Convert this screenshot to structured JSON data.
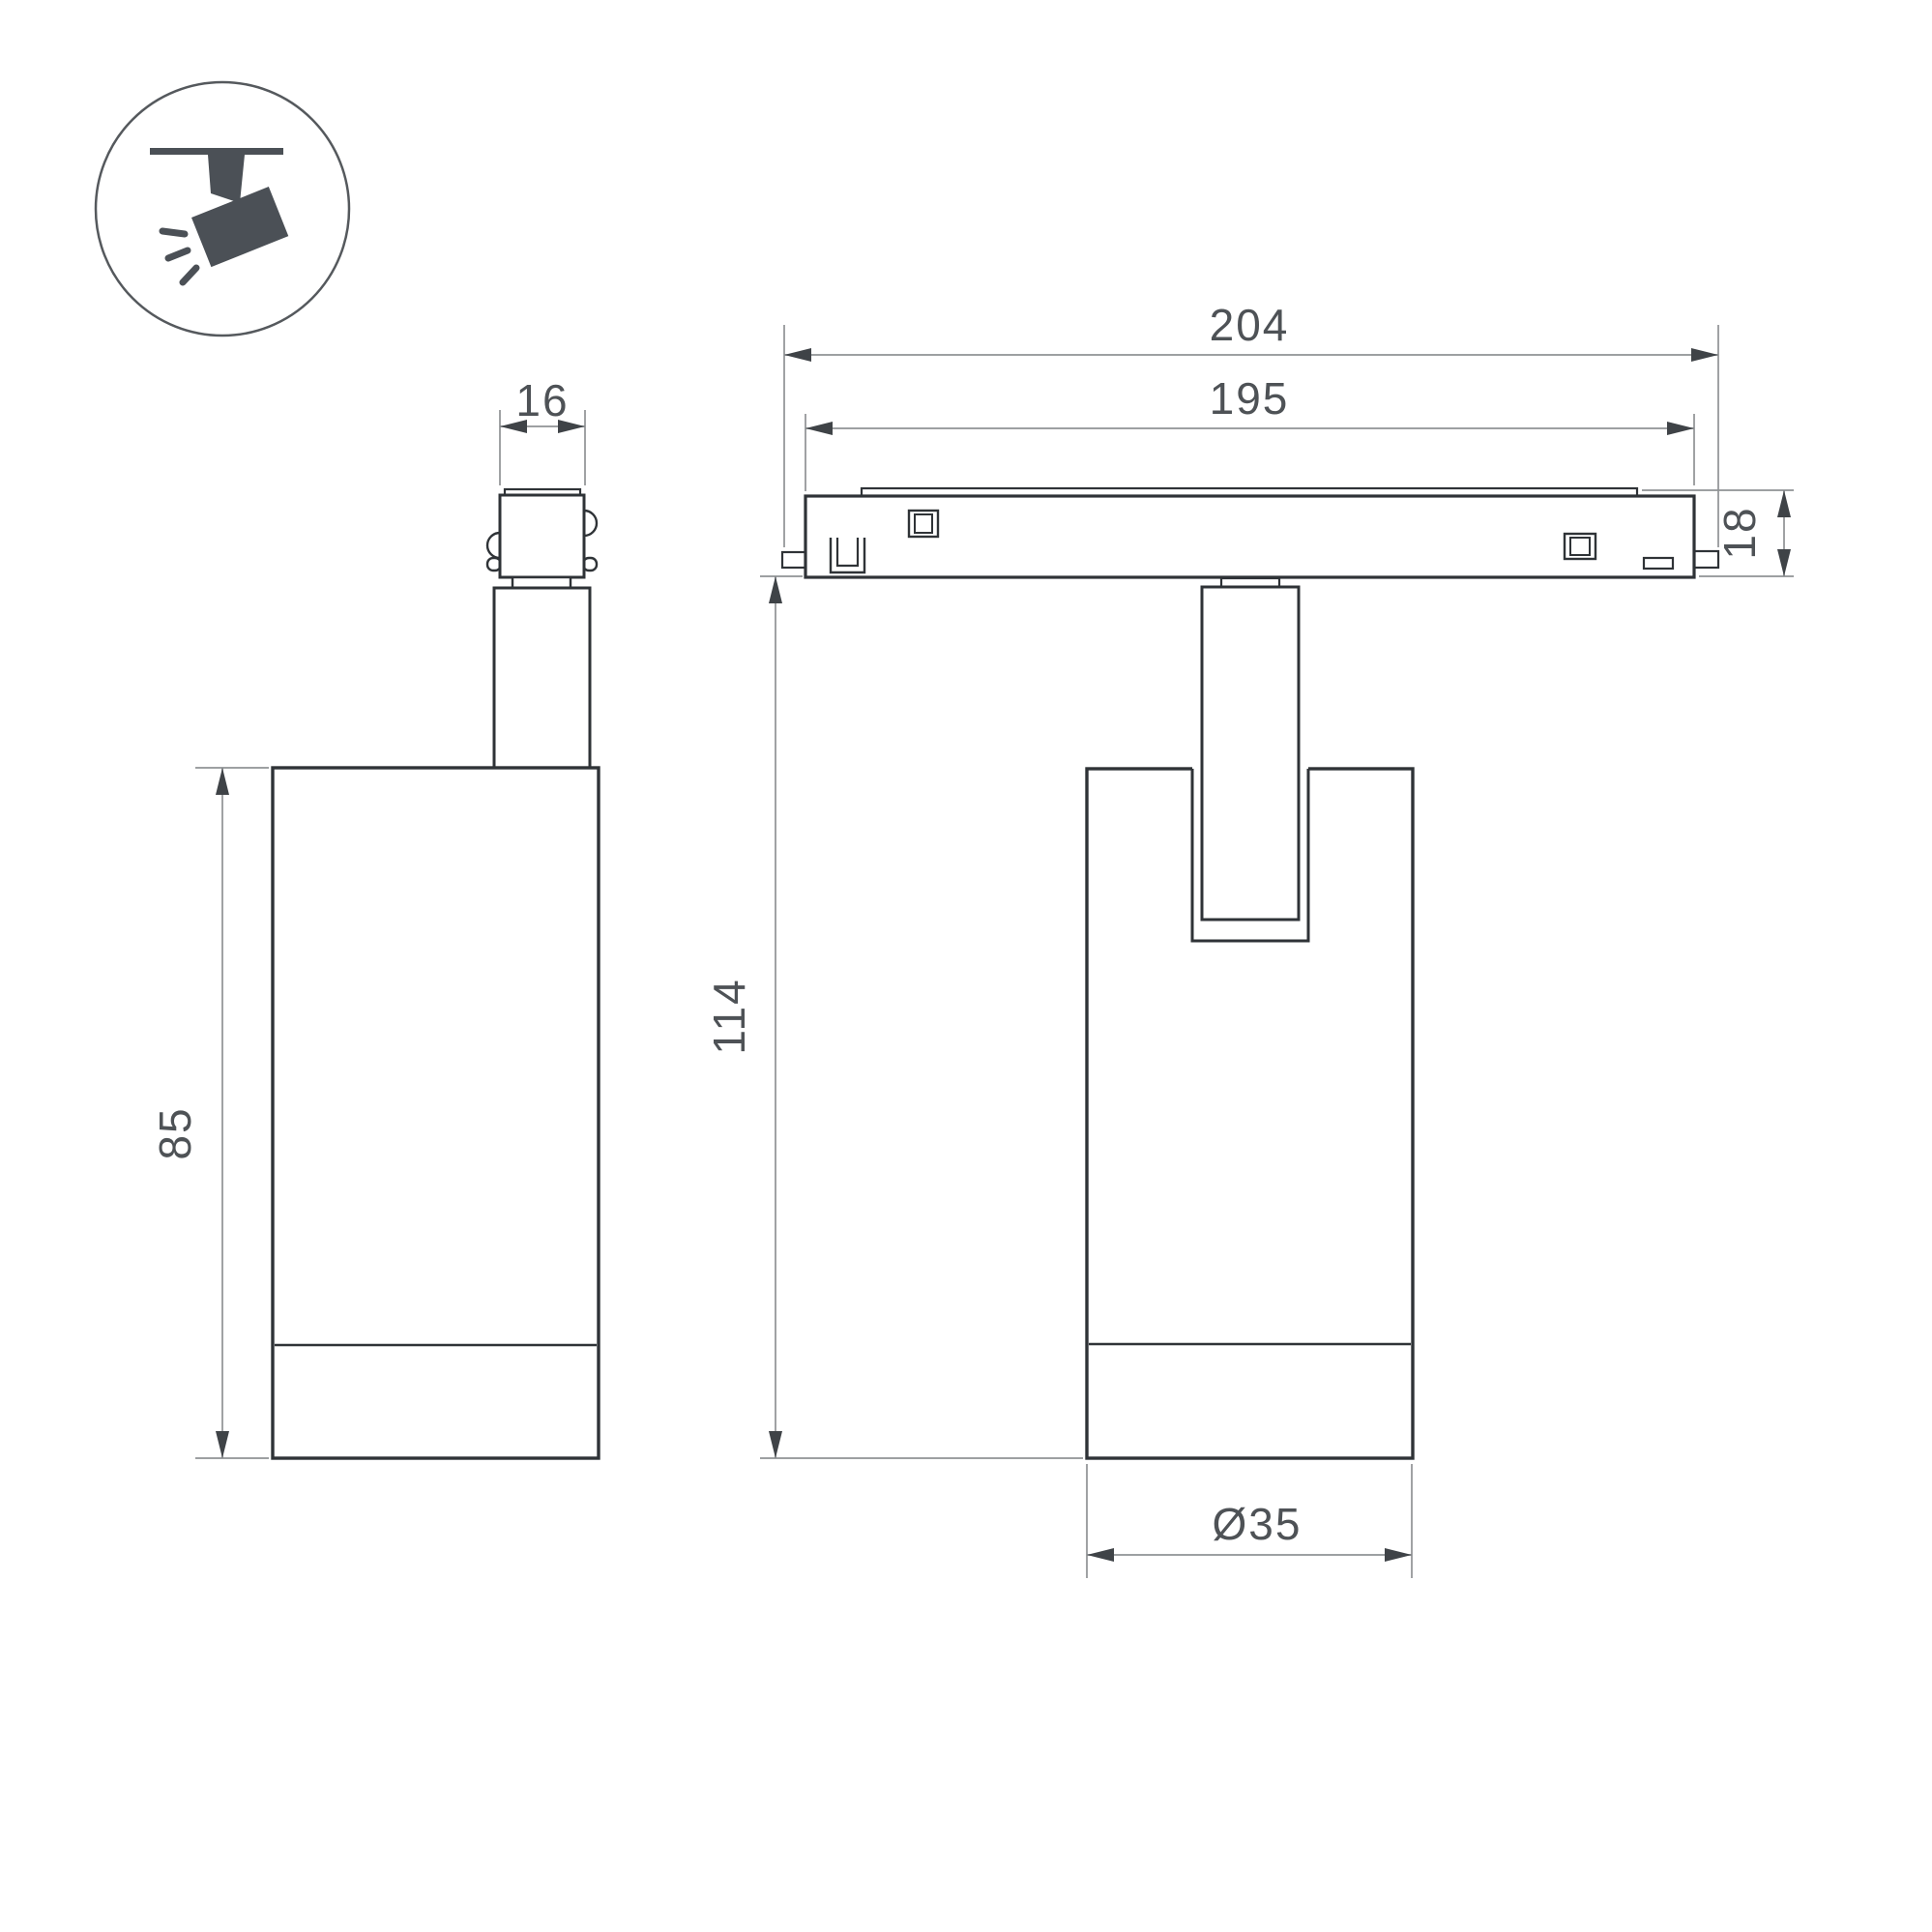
{
  "drawing": {
    "type": "technical-dimension-drawing",
    "subject": "magnetic-track-spotlight",
    "dimensions": {
      "adapter_width": "16",
      "base_total_length": "204",
      "base_body_length": "195",
      "base_height": "18",
      "body_height": "85",
      "overall_height": "114",
      "body_diameter": "Ø35"
    },
    "colors": {
      "object_line": "#2f3337",
      "dim_line": "#8f9294",
      "text": "#4e5256",
      "icon_fill": "#4b5056",
      "background": "#ffffff"
    },
    "icon": {
      "name": "track-spotlight-icon"
    }
  }
}
